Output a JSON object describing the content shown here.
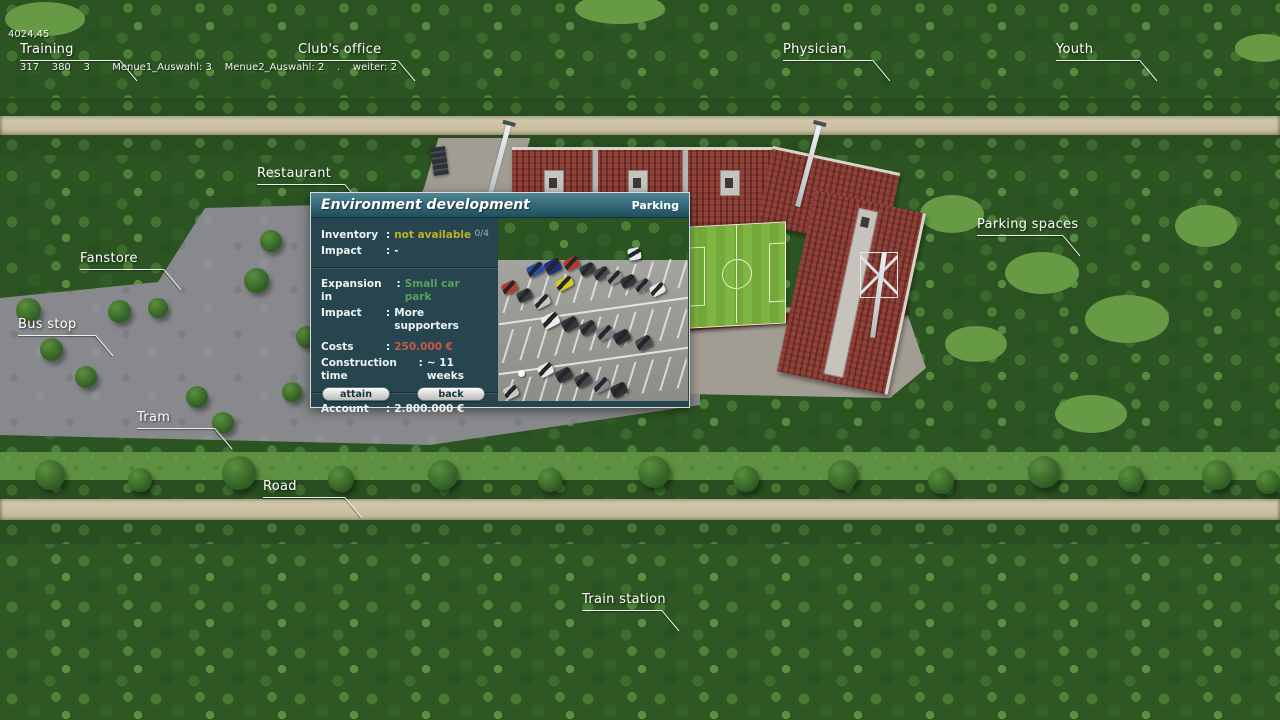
{
  "debug": {
    "line1": "4024,45",
    "line2": "317    380    3       Menue1_Auswahl: 3    Menue2_Auswahl: 2    .    weiter: 2"
  },
  "map_labels": {
    "training": "Training",
    "clubs_office": "Club's office",
    "physician": "Physician",
    "youth": "Youth",
    "restaurant": "Restaurant",
    "fanstore": "Fanstore",
    "bus_stop": "Bus stop",
    "tram": "Tram",
    "road": "Road",
    "train_station": "Train station",
    "parking_spaces": "Parking spaces"
  },
  "dialog": {
    "title": "Environment development",
    "category": "Parking",
    "counter": "0/4",
    "colon": ":",
    "rows": {
      "inventory": {
        "label": "Inventory",
        "value": "not available"
      },
      "impact_current": {
        "label": "Impact",
        "value": "-"
      },
      "expansion": {
        "label": "Expansion in",
        "value": "Small car park"
      },
      "impact_new": {
        "label": "Impact",
        "value": "More supporters"
      },
      "costs": {
        "label": "Costs",
        "value": "250.000 €"
      },
      "construction_time": {
        "label": "Construction time",
        "value": "~ 11 weeks"
      },
      "account": {
        "label": "Account",
        "value": "2.800.000 €"
      }
    },
    "buttons": {
      "attain": "attain",
      "back": "back"
    }
  },
  "colors": {
    "dialog_title_gradient_top": "#4d8496",
    "dialog_title_gradient_bottom": "#1f4f5c",
    "dialog_body": "#26454e",
    "value_unavailable": "#b9b229",
    "value_expansion": "#58a05c",
    "value_costs": "#c7584a",
    "label_text": "#ffffff",
    "stand_red": "#8c3a33",
    "pitch_green": "#7fb542"
  }
}
